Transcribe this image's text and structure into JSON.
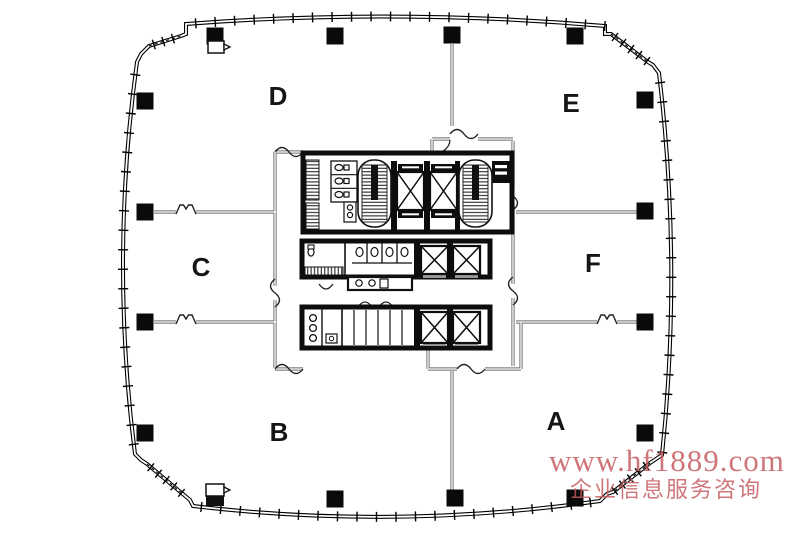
{
  "zones": [
    {
      "label": "D",
      "x": 278,
      "y": 105
    },
    {
      "label": "E",
      "x": 571,
      "y": 112
    },
    {
      "label": "C",
      "x": 201,
      "y": 276
    },
    {
      "label": "F",
      "x": 593,
      "y": 272
    },
    {
      "label": "B",
      "x": 279,
      "y": 441
    },
    {
      "label": "A",
      "x": 556,
      "y": 430
    }
  ],
  "watermark": {
    "line1": "www.hf1889.com",
    "line2": "企业信息服务咨询",
    "color": "#c4595c"
  }
}
